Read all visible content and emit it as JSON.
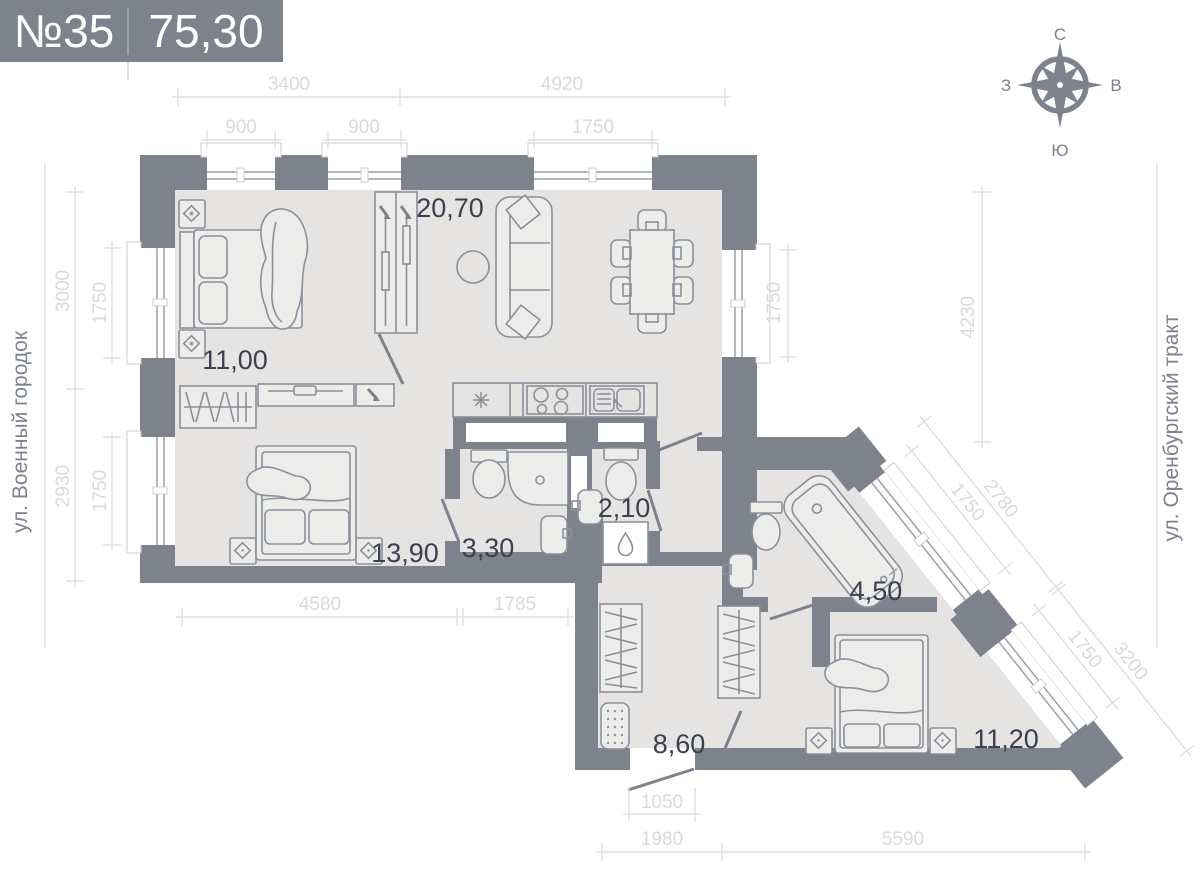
{
  "header": {
    "number": "№35",
    "area": "75,30"
  },
  "compass": {
    "north": "С",
    "east": "В",
    "south": "Ю",
    "west": "З"
  },
  "streets": {
    "left": "ул. Военный городок",
    "right": "ул. Оренбургский тракт"
  },
  "rooms": {
    "living": "20,70",
    "bedroom1": "11,00",
    "bedroom2": "13,90",
    "bathroom1": "3,30",
    "wc": "2,10",
    "bathroom2": "4,50",
    "hallway": "8,60",
    "bedroom3": "11,20"
  },
  "dimensions": {
    "top_outer": [
      "3400",
      "4920"
    ],
    "top_windows": [
      "900",
      "900",
      "1750"
    ],
    "left_outer": [
      "3000",
      "2930"
    ],
    "left_windows": [
      "1750",
      "1750"
    ],
    "right_window": "1750",
    "right_outer": "4230",
    "diag_upper": [
      "2780",
      "1750"
    ],
    "diag_lower": [
      "3200",
      "1750"
    ],
    "bottom_rooms": [
      "4580",
      "1785"
    ],
    "entrance": "1050",
    "bottom_outer": [
      "1980",
      "5590"
    ]
  },
  "colors": {
    "wall": "#7d828c",
    "floor": "#e5e4e2",
    "furniture_line": "#8b909a",
    "dimension": "#d9dadc",
    "room_label": "#3c4150",
    "header_bg": "#7d828c",
    "header_text": "#ffffff"
  }
}
